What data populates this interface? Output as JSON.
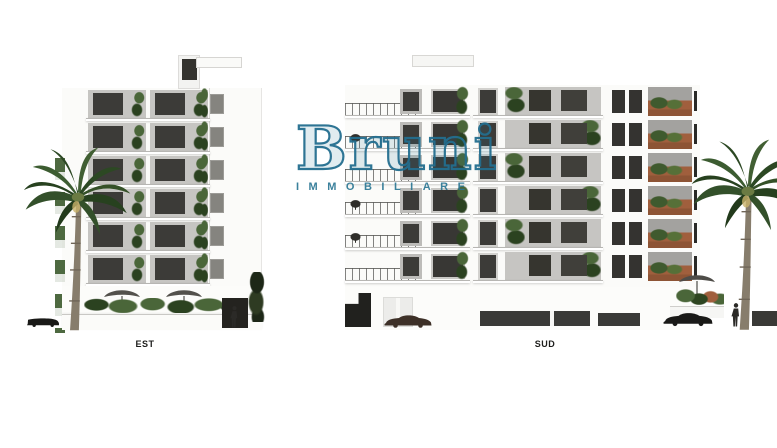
{
  "watermark": {
    "brand": "Bruni",
    "subtitle": "IMMOBILIARE"
  },
  "elevations": {
    "est": {
      "label": "EST"
    },
    "sud": {
      "label": "SUD"
    }
  },
  "colors": {
    "teal": "#2a7694",
    "ink": "#1d1d1b",
    "facade": "#fbfbf9",
    "recess": "#c6c5c2",
    "window": "#3c3b38",
    "slab": "#b7b6b3",
    "green": "#4a6639",
    "greendark": "#2b4220",
    "terracotta": "#a05f3d",
    "trunk": "#877d6c",
    "canopy": "#53514c",
    "car_dark": "#191917",
    "car_brown": "#3d3027",
    "band": "#3a3a37"
  }
}
